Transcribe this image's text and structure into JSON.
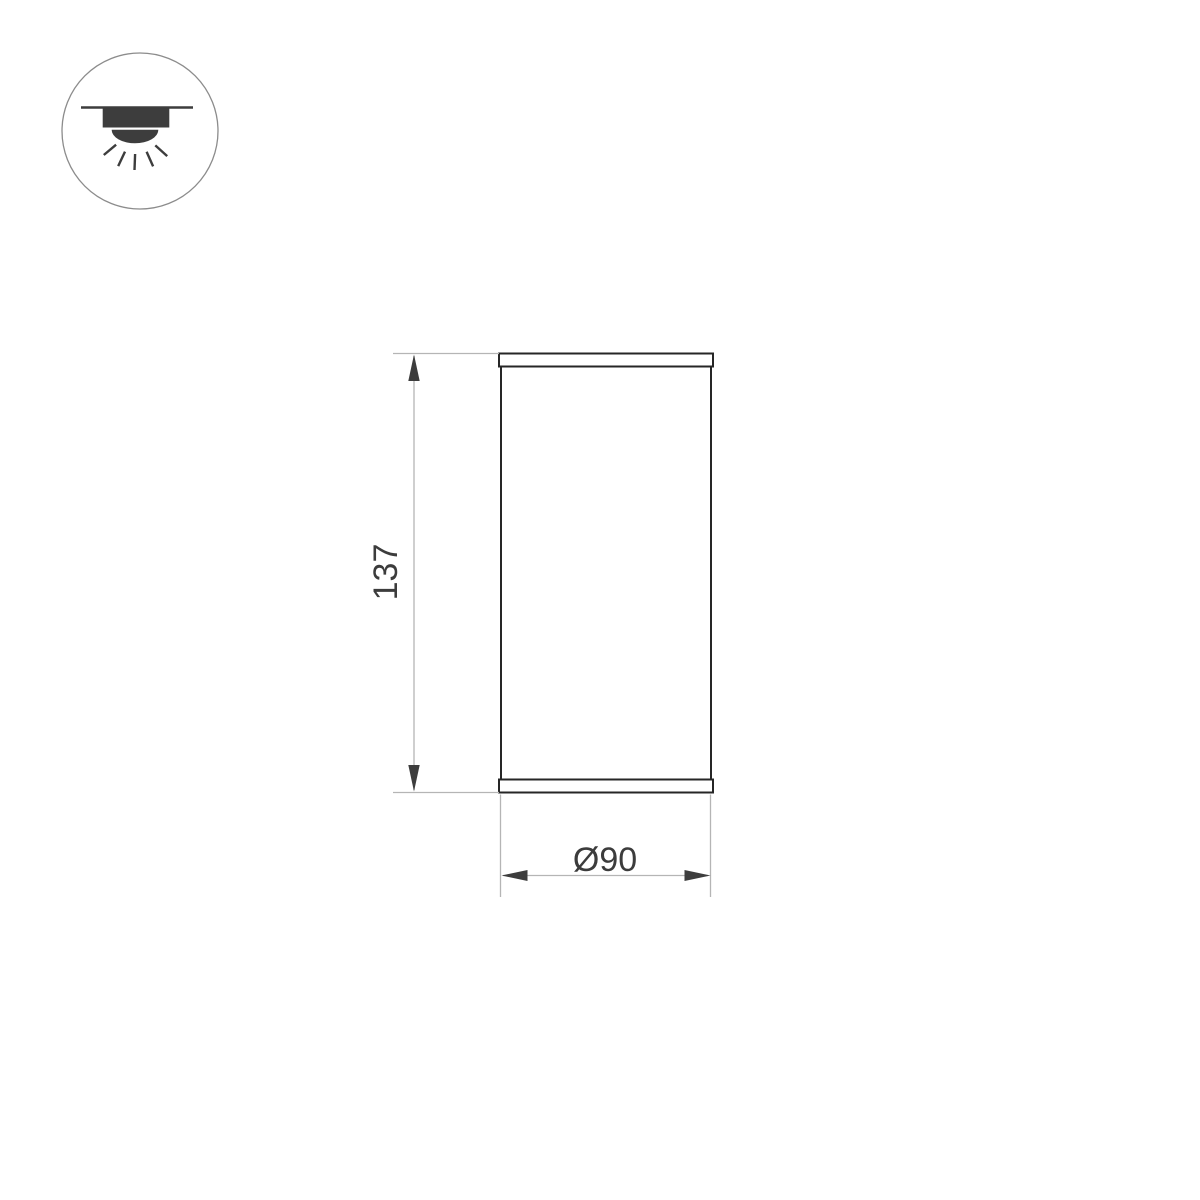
{
  "icons": {
    "mount_icon": "surface-mounted-ceiling-luminaire"
  },
  "dimension_drawing": {
    "height_label": "137",
    "diameter_label": "Ø90"
  },
  "colors": {
    "background": "#ffffff",
    "fixture_outline": "#262626",
    "dimension_line_gray": "#b5b5b5",
    "annotation_dark": "#3d3d3d",
    "text_dark": "#3c3c3c",
    "icon_circle_gray": "#8c8c8c"
  }
}
